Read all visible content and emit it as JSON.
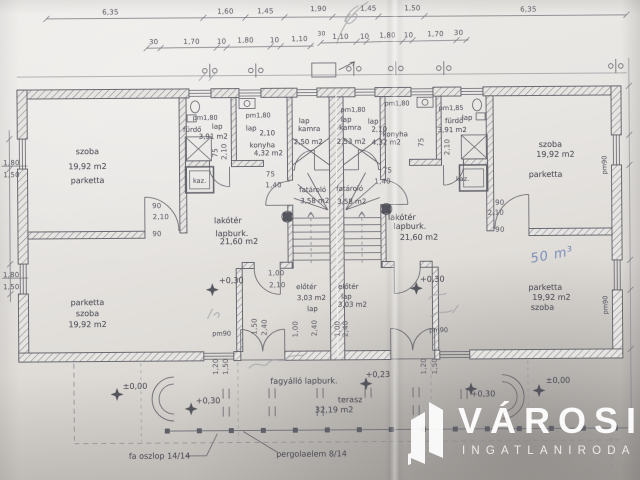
{
  "logo": {
    "title": "VÁROSI",
    "subtitle": "INGATLANIRODA"
  },
  "dims": {
    "t1a": "6,35",
    "t1b": "1,60",
    "t1c": "1,45",
    "t1d": "1,90",
    "t1e": "1,45",
    "t1f": "1,50",
    "t1g": "6,35",
    "t2a": "30",
    "t2b": "1,70",
    "t2c": "10",
    "t2d": "1,80",
    "t2e": "10",
    "t2f": "1,10",
    "t2g": "30",
    "t2h": "1,10",
    "t2i": "10",
    "t2j": "1,80",
    "t2k": "10",
    "t2l": "1,70",
    "t2m": "30",
    "lw1": "1,80",
    "lw2": "1,50",
    "lw3": "1,80",
    "lw4": "1,50",
    "d90a": "90",
    "d210a": "2,10",
    "d90b": "90",
    "d90c": "90",
    "d210b": "2,10",
    "d90d": "90",
    "e100": "1,00",
    "e210": "2,10",
    "e100b": "1,00",
    "e240": "2,40",
    "s75a": "75",
    "s140a": "1,40",
    "s75b": "75",
    "s140b": "1,40",
    "f75": "75",
    "f210": "2,10",
    "f75r": "75",
    "f210r": "2,10",
    "w120a": "1,20",
    "w150a": "1,50",
    "w150b": "1,50",
    "w240b": "2,40",
    "w100d": "1,00",
    "w240d": "2,40",
    "w120c": "1,20",
    "w150c": "1,50",
    "pm90a": "pm90",
    "pm90b": "pm90",
    "pm90c": "pm90",
    "pm90d": "pm90"
  },
  "rooms": {
    "szoba_tl": {
      "name": "szoba",
      "area": "19,92 m2",
      "floor": "parketta"
    },
    "szoba_bl": {
      "floor": "parketta",
      "name": "szoba",
      "area": "19,92 m2"
    },
    "szoba_tr": {
      "name": "szoba",
      "area": "19,92 m2",
      "floor": "parketta"
    },
    "szoba_br": {
      "floor": "parketta",
      "area": "19,92 m2",
      "name": "szoba"
    },
    "furdo_l": {
      "pm": "pm1,80",
      "name": "fürdő",
      "floor": "lap",
      "area": "3,91 m2"
    },
    "furdo_r": {
      "pm": "pm1,85",
      "name": "fürdő",
      "area": "3,91 m2",
      "floor": "lap"
    },
    "konyha_l": {
      "pm": "pm1,80",
      "floor": "lap",
      "h": "2,10",
      "name": "konyha",
      "area": "4,32 m2"
    },
    "konyha_r": {
      "pm": "pm1,80",
      "floor": "lap",
      "h": "2,10",
      "name": "konyha",
      "area": "4,32 m2"
    },
    "kamra_l": {
      "floor": "lap",
      "name": "kamra",
      "area": "2,50 m2"
    },
    "kamra_r": {
      "pm": "pm1,80",
      "floor": "lap",
      "name": "kamra",
      "area": "2,53 m2"
    },
    "fatarolo_l": {
      "name": "fatároló",
      "area": "3,58 m2"
    },
    "fatarolo_r": {
      "name": "fatároló",
      "area": "3,58 m2"
    },
    "lakoter_l": {
      "name": "lakótér",
      "floor": "lapburk.",
      "area": "21,60 m2"
    },
    "lakoter_r": {
      "name": "lakótér",
      "floor": "lapburk.",
      "area": "21,60 m2"
    },
    "eloter_l": {
      "name": "előtér",
      "area": "3,03 m2",
      "floor": "lap"
    },
    "eloter_r": {
      "name": "előtér",
      "floor": "lap",
      "area": "3,03 m2"
    },
    "kaz_l": "kaz.",
    "kaz_r": "kaz.",
    "terasz": {
      "name": "terasz",
      "area": "32,19 m2",
      "floor": "fagyálló lapburk."
    }
  },
  "levels": {
    "l030a": "+0,30",
    "l030b": "+0,30",
    "l030c": "+0,30",
    "l030d": "+0,30",
    "l000a": "±0,00",
    "l000b": "±0,00",
    "l023": "+0,23"
  },
  "notes": {
    "fa_oszlop": "fa oszlop 14/14",
    "pergola": "pergolaelem 8/14",
    "hand_blue": "50 m³"
  }
}
